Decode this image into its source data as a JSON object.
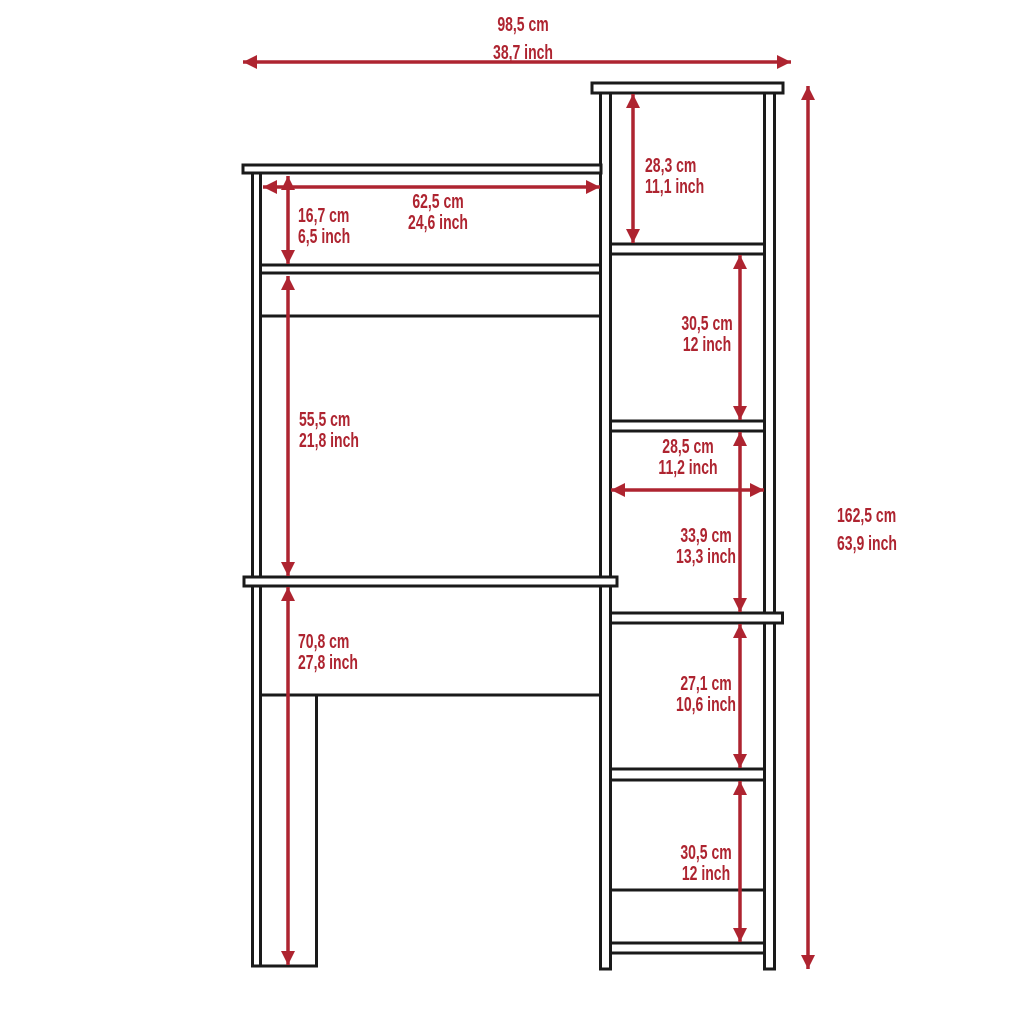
{
  "diagram": {
    "accent_color": "#AE2430",
    "line_color": "#1a1a1a",
    "dims": {
      "overall_width": {
        "cm": "98,5 cm",
        "inch": "38,7 inch"
      },
      "overall_height": {
        "cm": "162,5 cm",
        "inch": "63,9 inch"
      },
      "hutch_width": {
        "cm": "62,5 cm",
        "inch": "24,6 inch"
      },
      "hutch_cubby": {
        "cm": "16,7 cm",
        "inch": "6,5 inch"
      },
      "hutch_opening": {
        "cm": "55,5 cm",
        "inch": "21,8 inch"
      },
      "desk_clearance": {
        "cm": "70,8 cm",
        "inch": "27,8 inch"
      },
      "shelf_top": {
        "cm": "28,3 cm",
        "inch": "11,1 inch"
      },
      "shelf_2": {
        "cm": "30,5 cm",
        "inch": "12 inch"
      },
      "shelf_width": {
        "cm": "28,5 cm",
        "inch": "11,2 inch"
      },
      "shelf_3": {
        "cm": "33,9 cm",
        "inch": "13,3 inch"
      },
      "shelf_4": {
        "cm": "27,1 cm",
        "inch": "10,6 inch"
      },
      "shelf_5": {
        "cm": "30,5 cm",
        "inch": "12 inch"
      }
    }
  }
}
